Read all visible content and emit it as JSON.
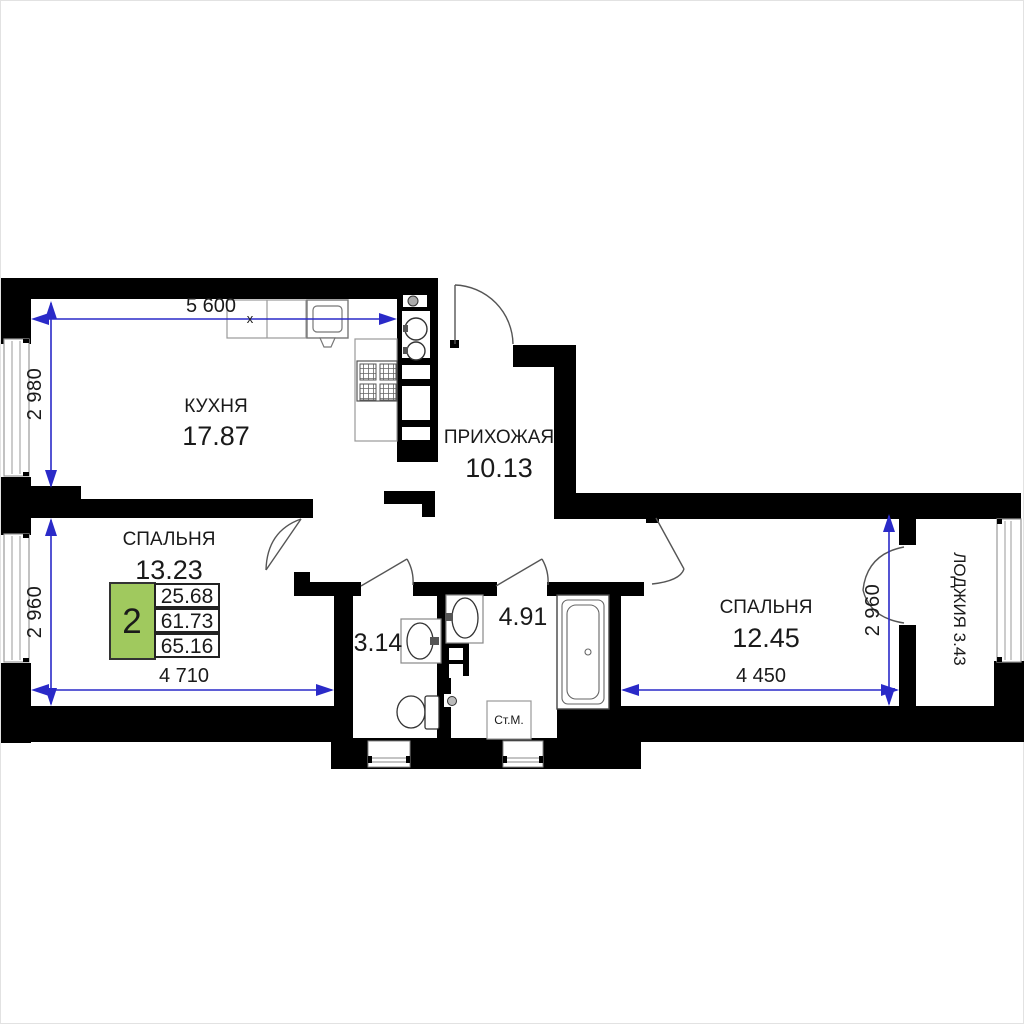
{
  "plan": {
    "title": "2-room apartment floor plan",
    "summary": {
      "rooms_count": "2",
      "living_area": "25.68",
      "area_without_loggia": "61.73",
      "total_area": "65.16"
    },
    "rooms": {
      "kitchen": {
        "name": "КУХНЯ",
        "area": "17.87"
      },
      "hallway": {
        "name": "ПРИХОЖАЯ",
        "area": "10.13"
      },
      "bedroom1": {
        "name": "СПАЛЬНЯ",
        "area": "13.23"
      },
      "bedroom2": {
        "name": "СПАЛЬНЯ",
        "area": "12.45"
      },
      "wc": {
        "area": "3.14"
      },
      "bathroom": {
        "area": "4.91"
      },
      "loggia": {
        "label": "ЛОДЖИЯ 3.43"
      }
    },
    "fixtures": {
      "washing_machine": "Ст.М."
    },
    "dimensions": {
      "kitchen_width": "5 600",
      "kitchen_depth": "2 980",
      "bedroom1_width": "4 710",
      "bedroom1_depth": "2 960",
      "bedroom2_width": "4 450",
      "bedroom2_depth": "2 960",
      "break_mark": "х"
    },
    "colors": {
      "wall": "#000000",
      "dimension_blue": "#2a2ac8",
      "accent_green": "#a0c95e"
    }
  }
}
